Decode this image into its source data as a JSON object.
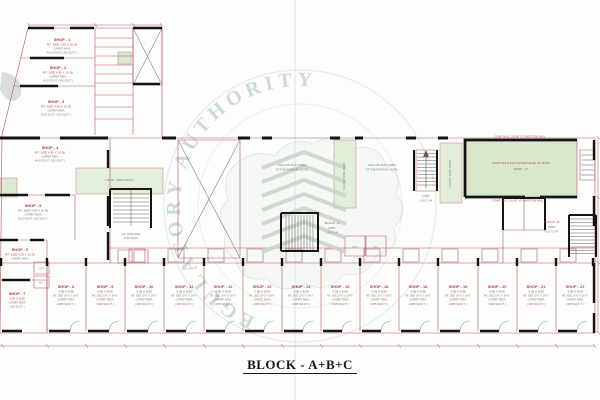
{
  "title": {
    "text": "BLOCK - A+B+C"
  },
  "watermark": {
    "circle_text": "GUJARAT REAL ESTATE REGULATORY AUTHORITY"
  },
  "plan": {
    "rooms": {
      "shop1": {
        "label": "SHOP - 1"
      },
      "shop2": {
        "label": "SHOP - 2"
      },
      "shop3": {
        "label": "SHOP - 3"
      },
      "shop4": {
        "label": "SHOP - 4"
      },
      "shop5": {
        "label": "SHOP - 5"
      },
      "shop6": {
        "label": "SHOP - 6"
      },
      "shop7": {
        "label": "SHOP - 7"
      },
      "common": {
        "size": "MT. SIZE 4.50 X 10.36",
        "carpet": "CARPET AREA",
        "area": "46.62 SQ.MT. ( 502 SQ.FT. )"
      }
    },
    "bottom_shops": [
      {
        "label": "SHOP - 8"
      },
      {
        "label": "SHOP - 9"
      },
      {
        "label": "SHOP - 10"
      },
      {
        "label": "SHOP - 11"
      },
      {
        "label": "SHOP - 12"
      },
      {
        "label": "SHOP - 13"
      },
      {
        "label": "SHOP - 14"
      },
      {
        "label": "SHOP - 15"
      },
      {
        "label": "SHOP - 16"
      },
      {
        "label": "SHOP - 18"
      },
      {
        "label": "SHOP - 19"
      },
      {
        "label": "SHOP - 20"
      },
      {
        "label": "SHOP - 21"
      },
      {
        "label": "SHOP - 22"
      }
    ],
    "shop_common": {
      "size": "3.05 X 8.08",
      "mt": "MT. SIZE 10'-0\" X 26'-6\"",
      "carpet": "CARPET AREA",
      "sqm": "24.64 SQ.MT.",
      "sqft": "( 265 SQ.FT. )"
    },
    "labels": {
      "parking_line1": "HOLLOW PLOT AREA",
      "parking_line2": "AT THE PARKING LEVEL",
      "green_shop_line1": "SHOP WITH 1ST FLOOR LEVEL AT SHOP",
      "green_shop_line2": "SHOP - 17",
      "green_shop_note": "COMP. WALL 1.50 MT. HT. PARTITION WALL",
      "road1": "6.00 MT. WIDE ROAD",
      "road2": "4.50 MT. WIDE ROAD",
      "entry": "7.50 MT. WIDE ENTRY",
      "block_a": "BLOCK - A",
      "block_b": "BLOCK - B",
      "lobby": "LOBBY",
      "lobby_dim": "3.05 X 2.44",
      "lobby_dim_a": "6.05 X 2.44",
      "stair_note1": "LVL. WISE AREA",
      "stair_note2": "10.80 SQ.MT.",
      "lift": "LIFT",
      "wc": "W.C."
    }
  }
}
